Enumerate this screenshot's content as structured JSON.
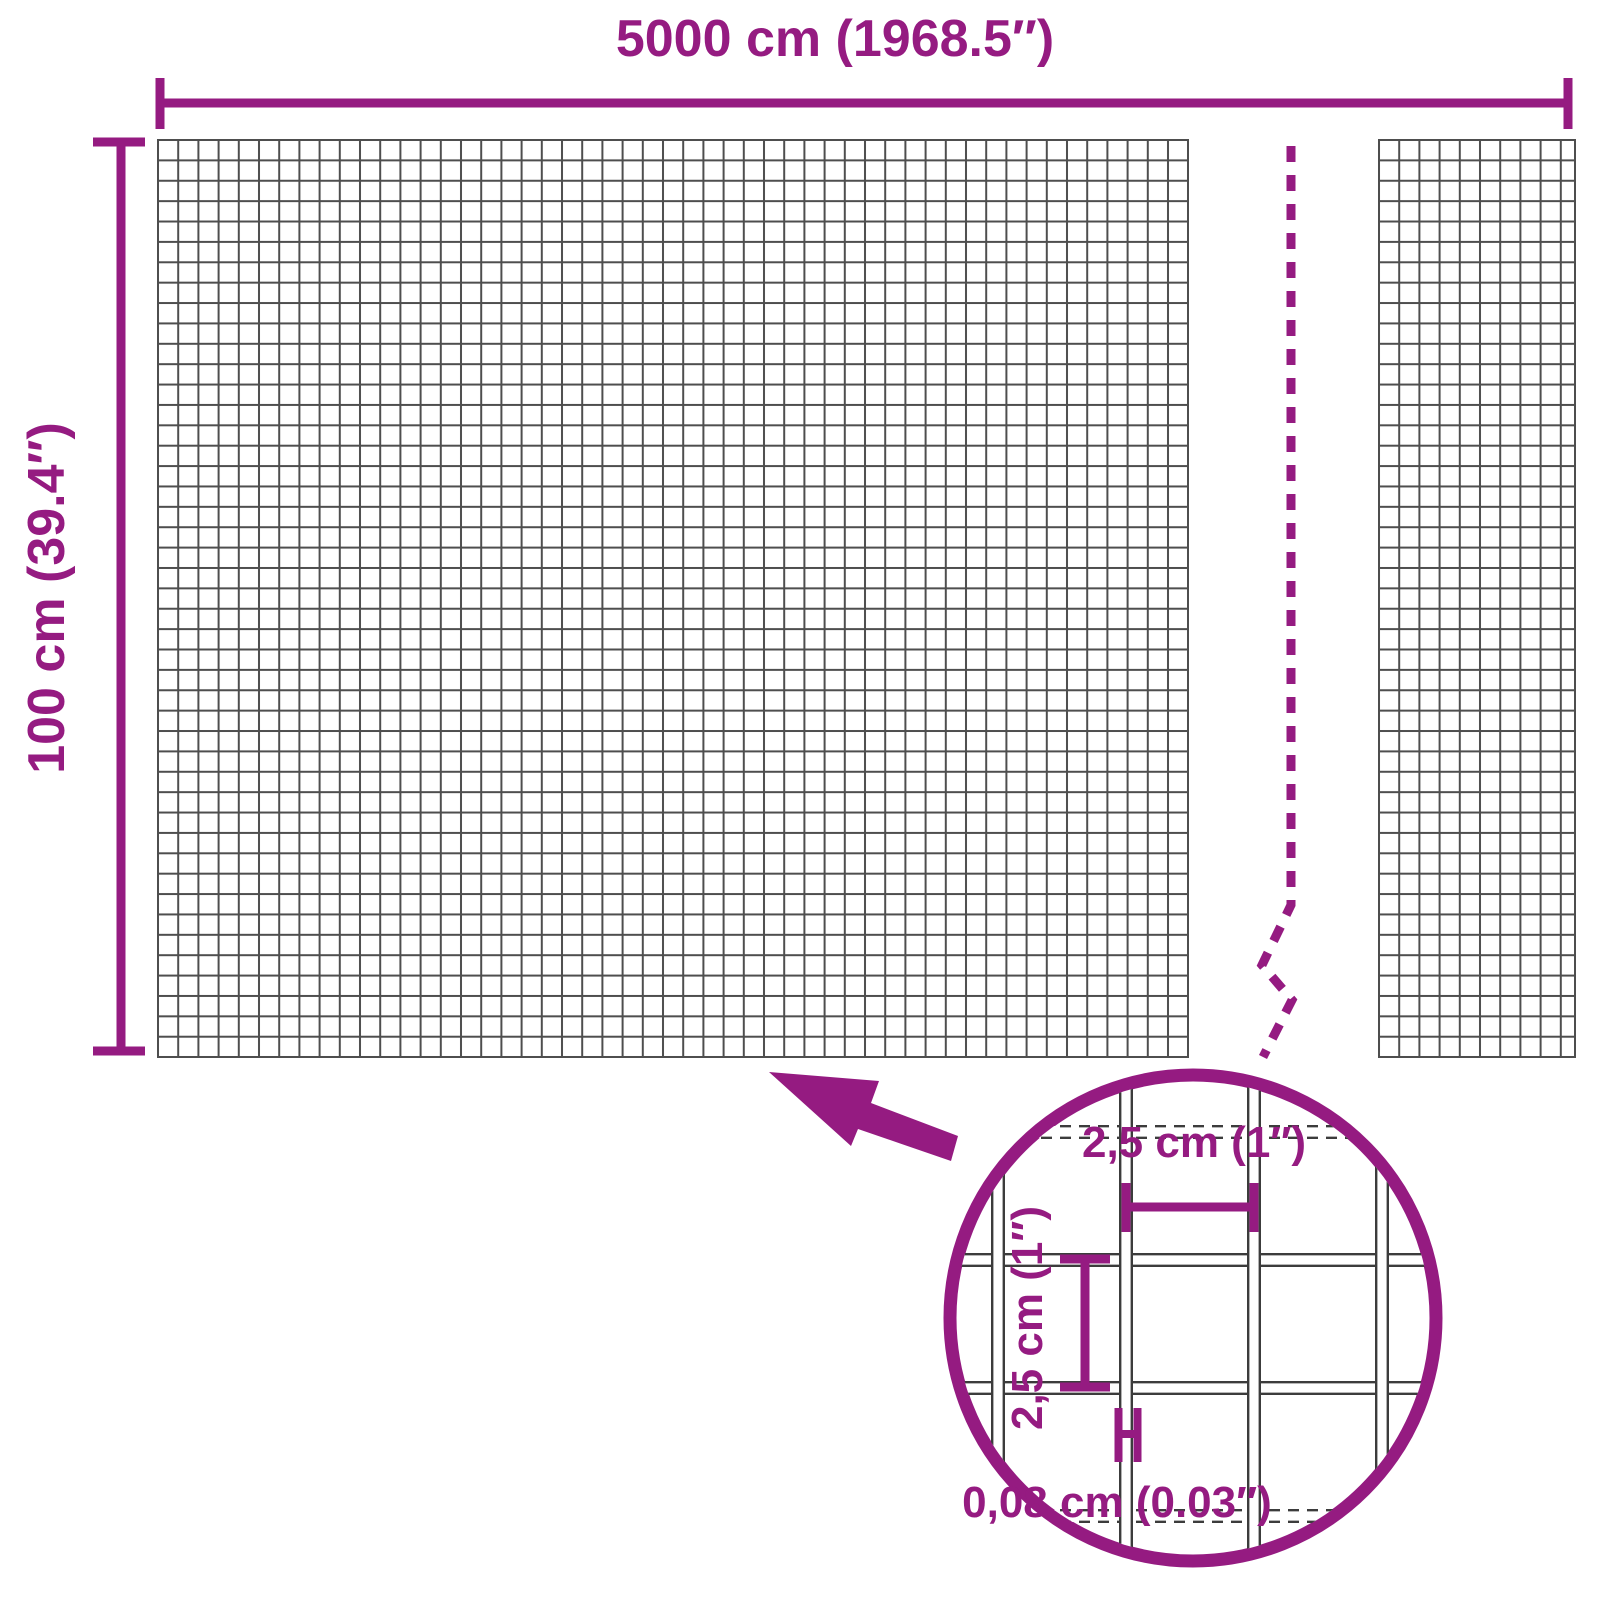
{
  "diagram": {
    "title": "wire-mesh-panel-dimension-diagram",
    "overall_width_label": "5000 cm (1968.5″)",
    "overall_height_label": "100 cm (39.4″)",
    "detail": {
      "mesh_opening_width_label": "2,5 cm (1″)",
      "mesh_opening_height_label": "2,5 cm (1″)",
      "wire_thickness_label": "0,08 cm (0.03″)"
    },
    "colors": {
      "accent_purple": "#951b81",
      "panel_grid_gray": "#4e4e4e",
      "detail_wire_gray": "#3c3c3c",
      "background": "#ffffff"
    }
  }
}
